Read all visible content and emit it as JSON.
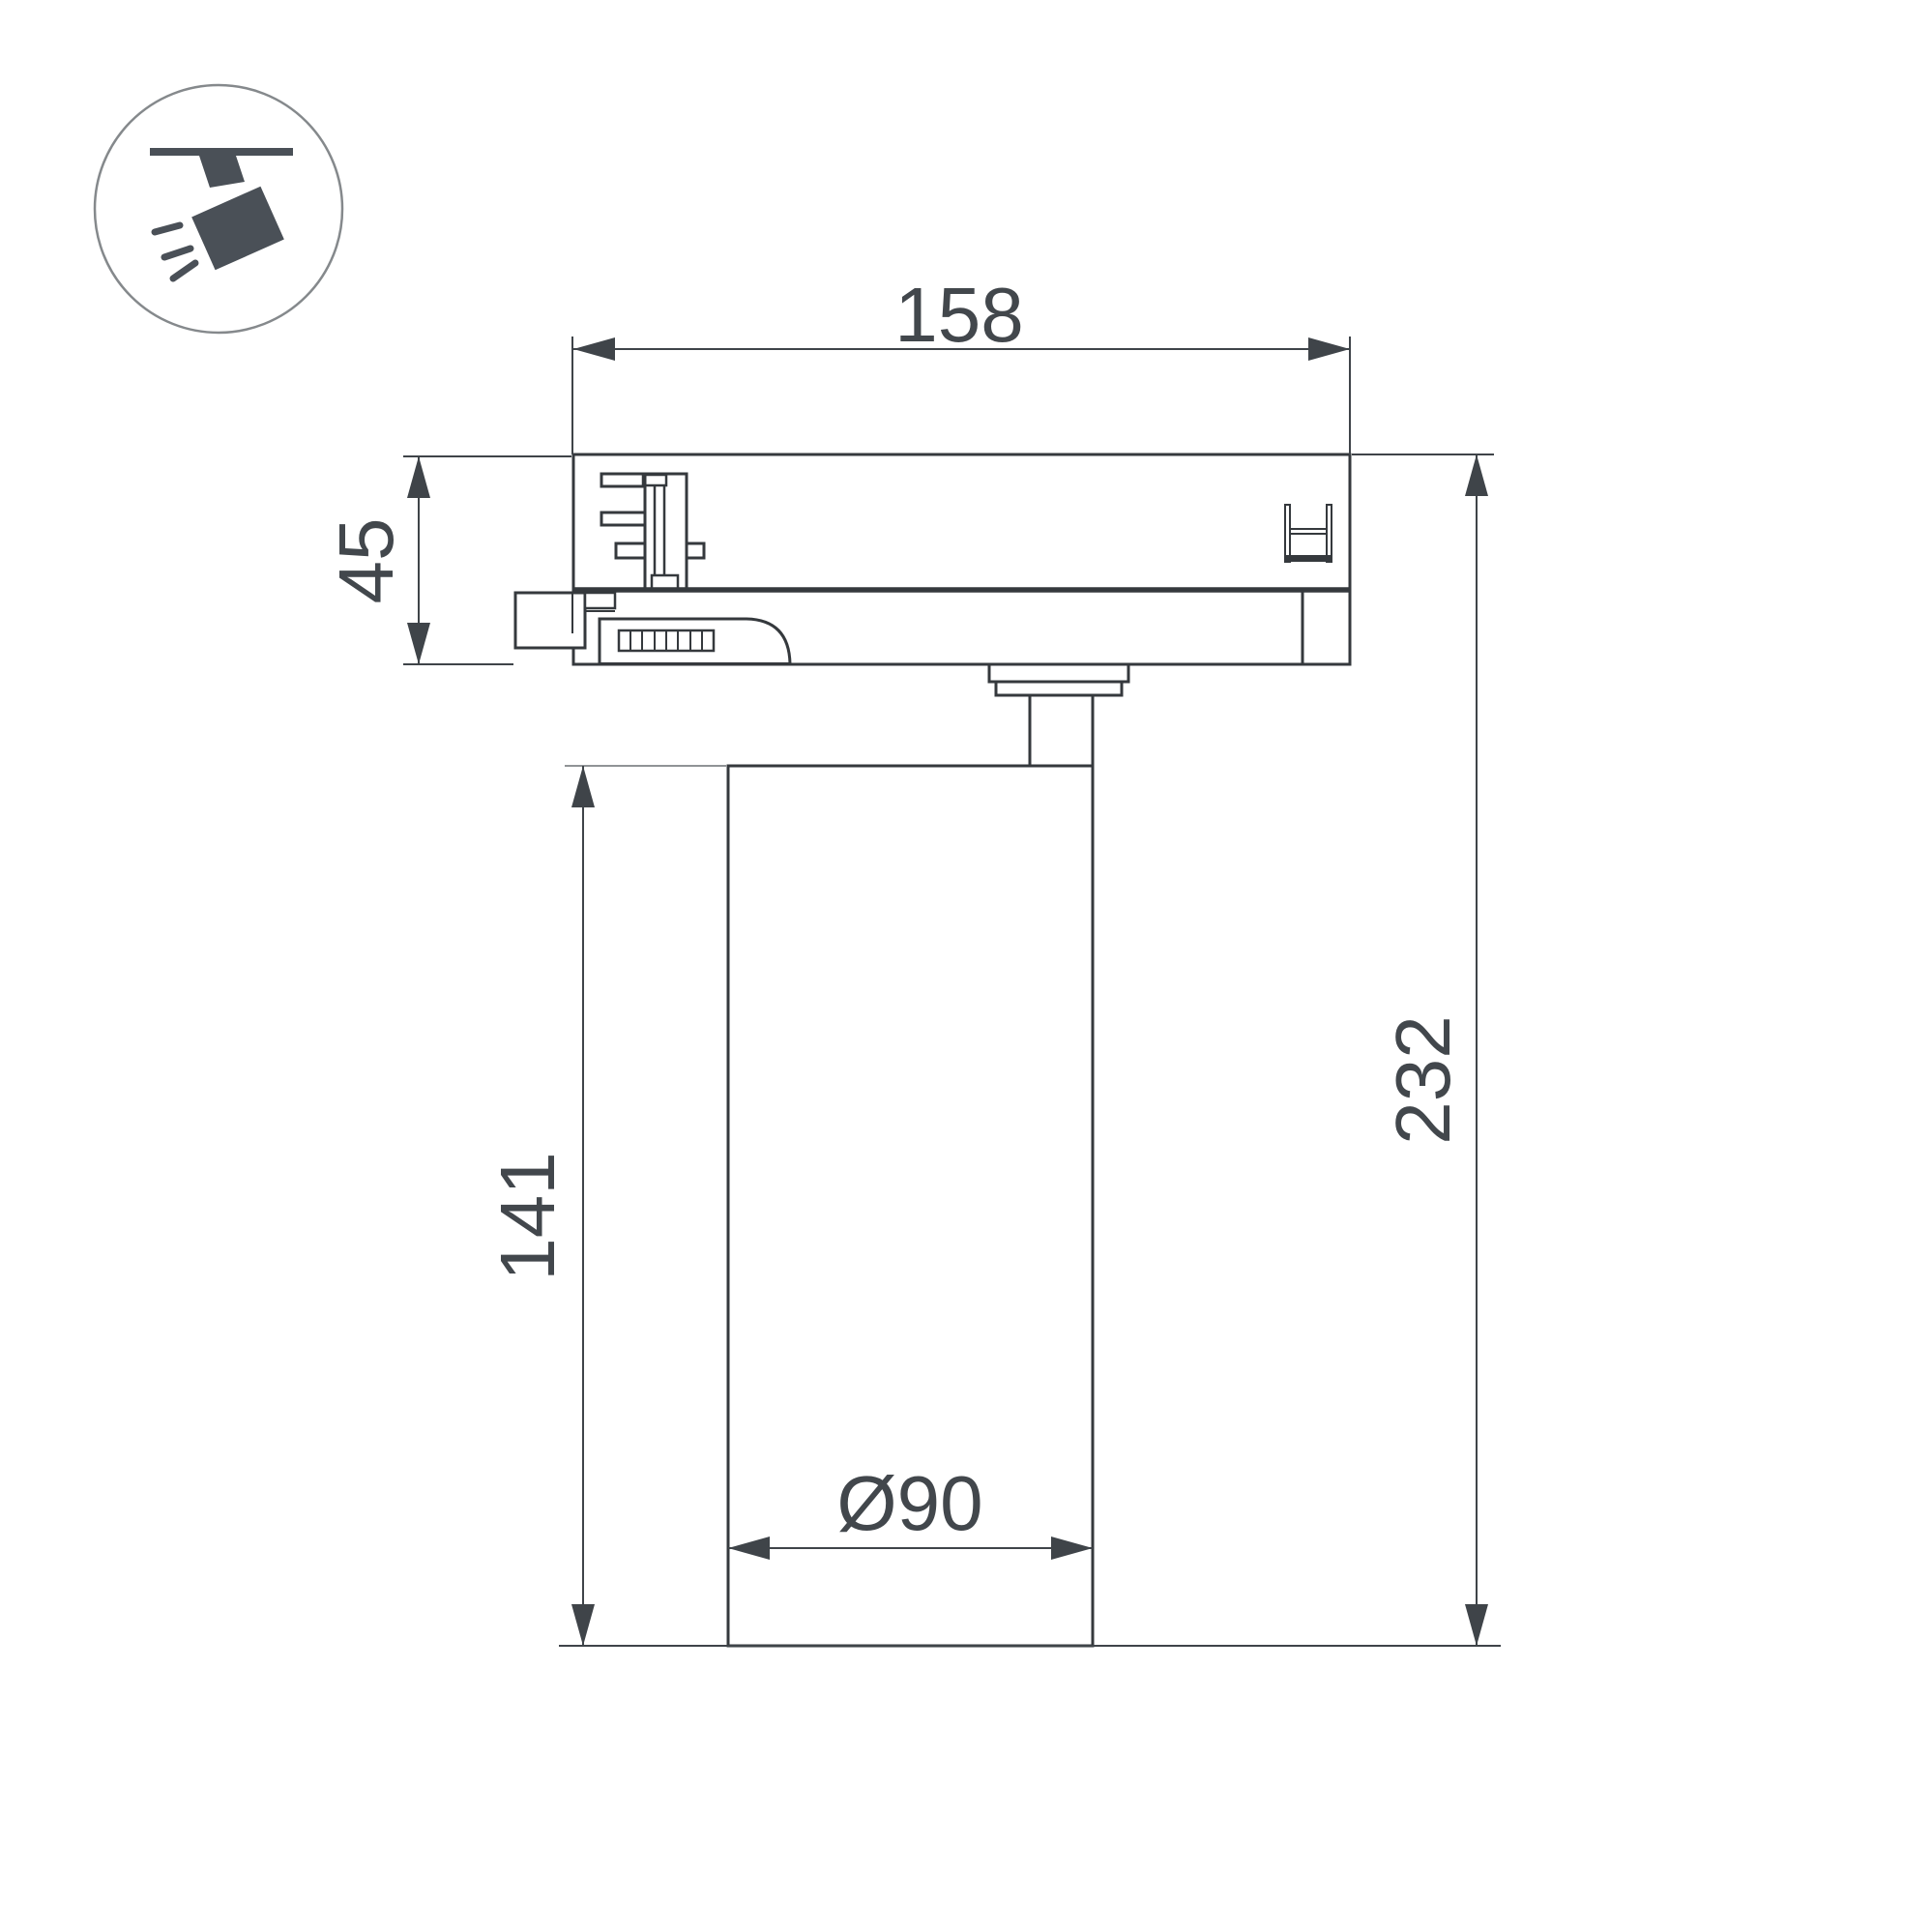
{
  "page": {
    "background": "#ffffff"
  },
  "icon": {
    "name": "track-spotlight-icon"
  },
  "colors": {
    "background": "#ffffff",
    "line": "#35393d",
    "dim": "#3f4449",
    "text": "#42474c",
    "extension": "#909396",
    "icon_glyph": "#4a5057",
    "icon_circle": "#85898c",
    "white": "#ffffff"
  },
  "dimensions": {
    "adapter_width_mm": "158",
    "adapter_height_mm": "45",
    "body_height_mm": "141",
    "overall_height_mm": "232",
    "body_diameter_mm": "Ø90"
  }
}
